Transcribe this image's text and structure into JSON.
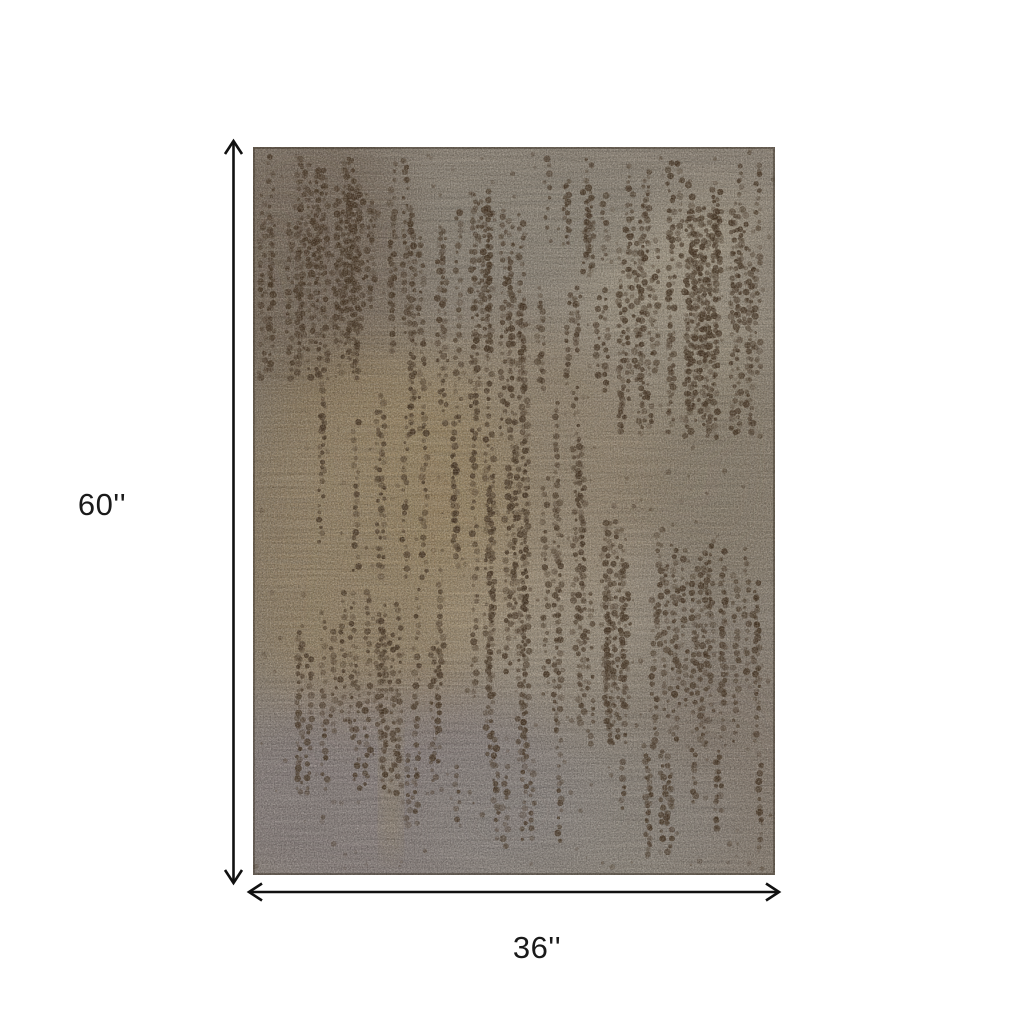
{
  "diagram": {
    "height_label": "60''",
    "width_label": "36''",
    "colors": {
      "background": "#ffffff",
      "arrow": "#111111",
      "label_text": "#1a1a1a",
      "rug_base": "#978c7e",
      "rug_gold": "#a78c5f",
      "rug_dark_patch": "#6b5a47",
      "rug_light_beige": "#c6b99f",
      "rug_gray_mauve": "#8d8389",
      "rug_dot": "#4a3826"
    }
  }
}
